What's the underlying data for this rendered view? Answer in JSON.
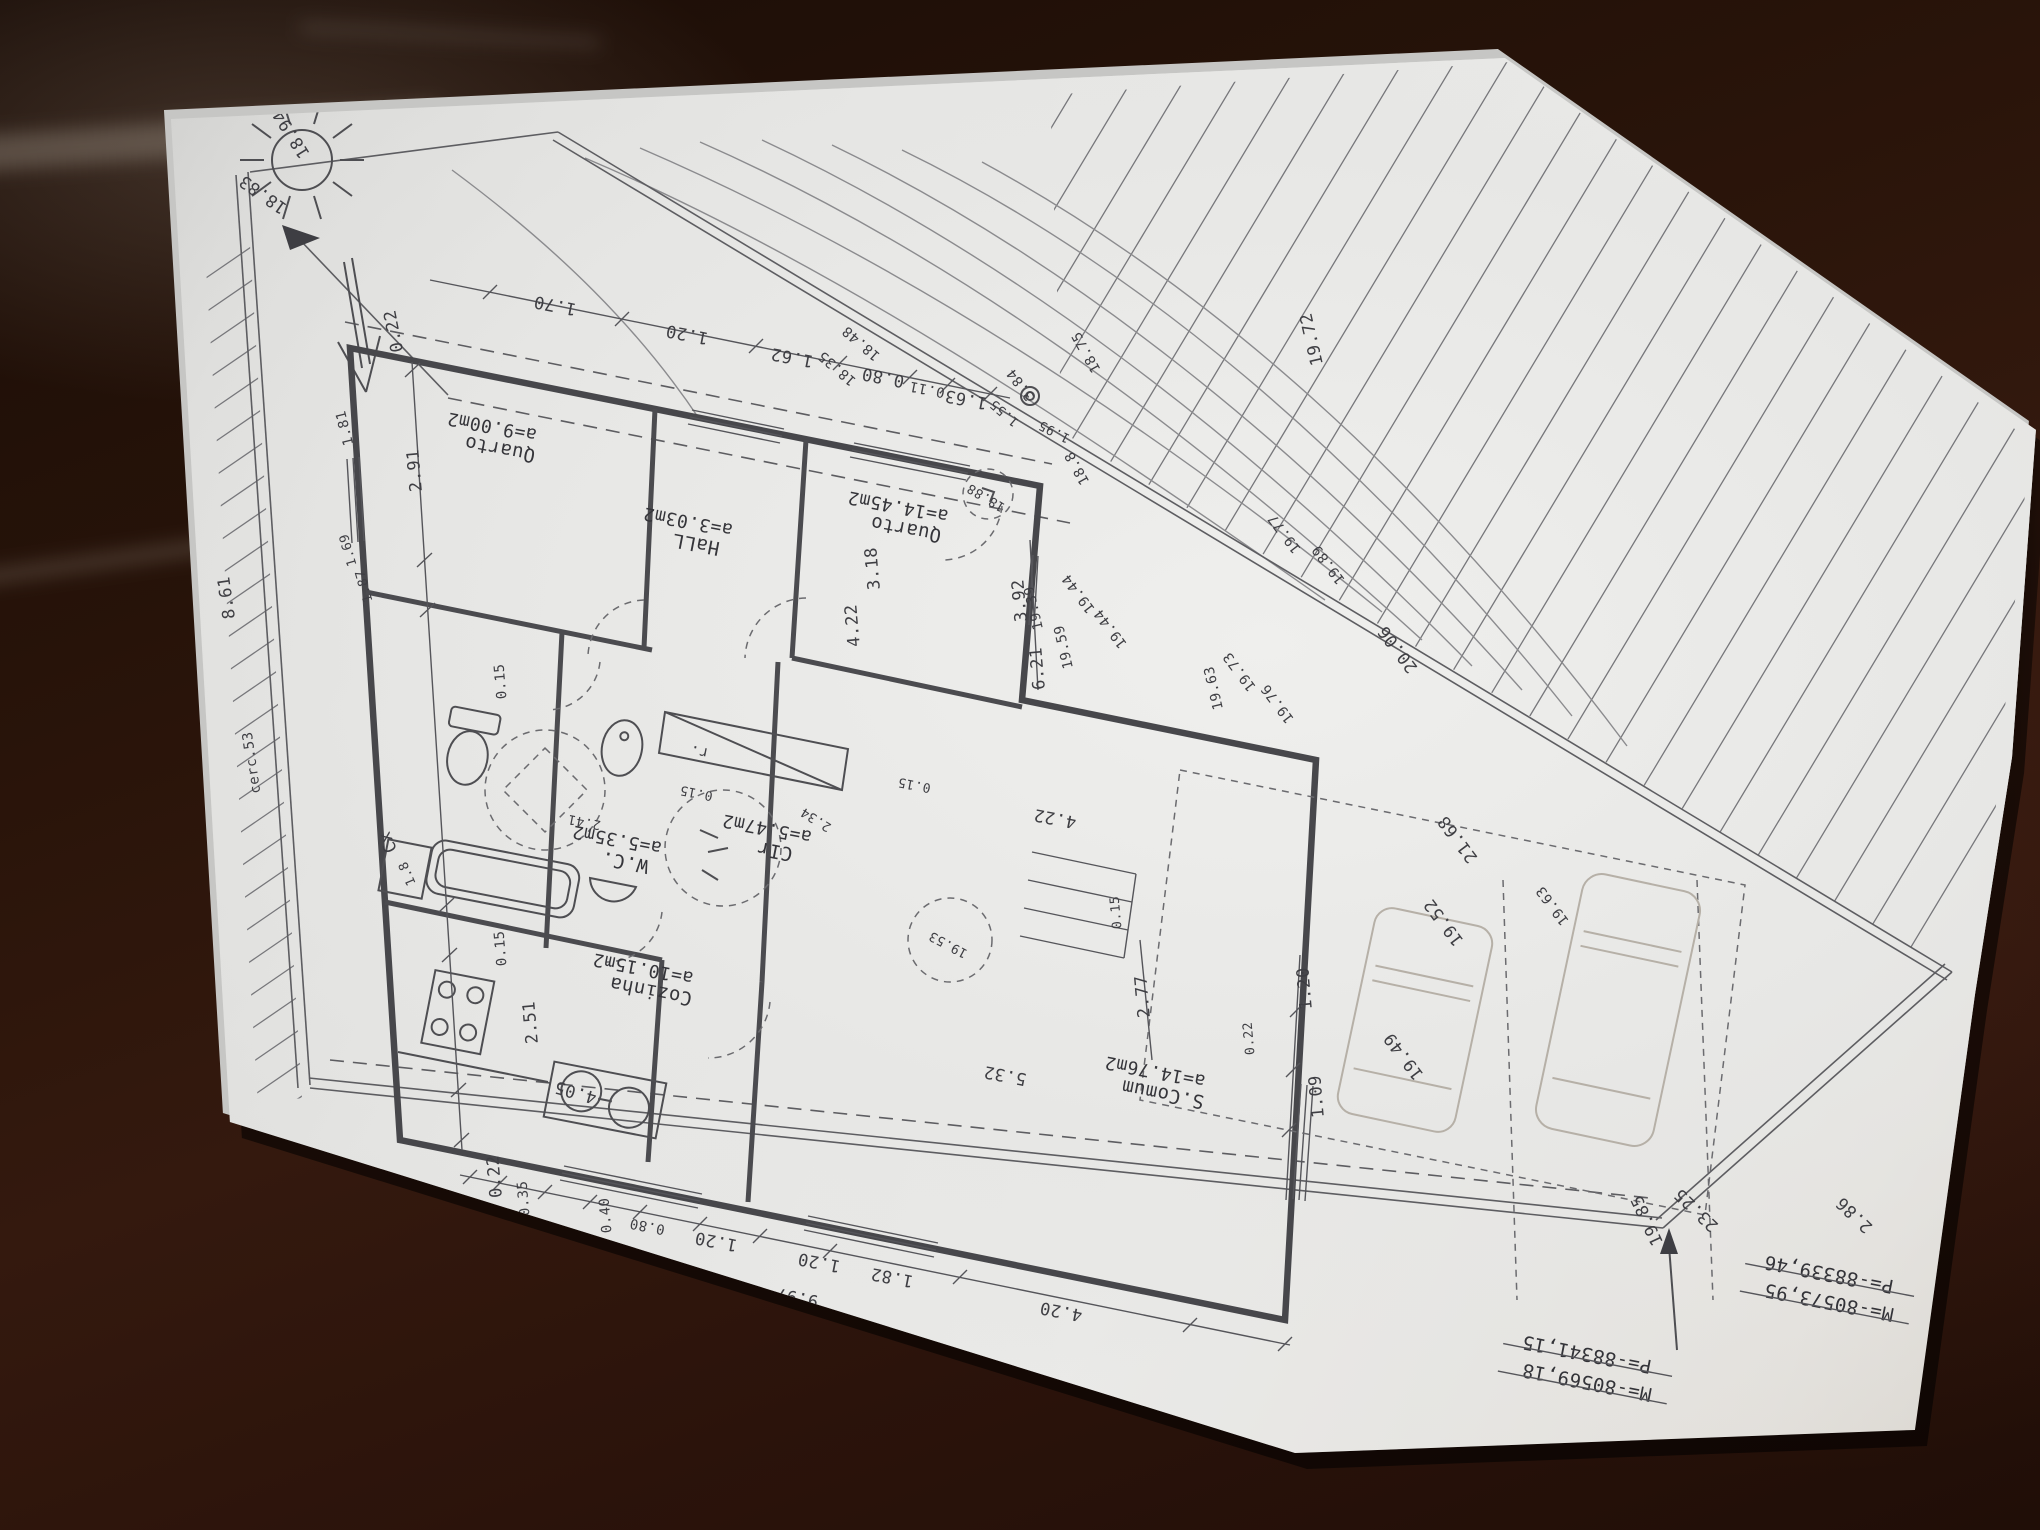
{
  "scene": {
    "type": "floor-plan-photo",
    "paper_color": "#e9e9e7",
    "ink_color": "#3e3e43",
    "wood_color": "#2b150c",
    "faint_ink": "#b6b0a7"
  },
  "plan": {
    "rooms": [
      {
        "name": "Quarto",
        "area": "a=9.00m2",
        "x": 497,
        "y": 432,
        "r": 191
      },
      {
        "name": "HaLL",
        "area": "a=3.03m2",
        "x": 693,
        "y": 527,
        "r": 191
      },
      {
        "name": "Quarto",
        "area": "a=14.45m2",
        "x": 903,
        "y": 512,
        "r": 191
      },
      {
        "name": "W.C.",
        "area": "a=5.35m2",
        "x": 622,
        "y": 845,
        "r": 191
      },
      {
        "name": "CIr",
        "area": "a=5.47m2",
        "x": 772,
        "y": 834,
        "r": 191
      },
      {
        "name": "Cozinha",
        "area": "a=10.15m2",
        "x": 648,
        "y": 974,
        "r": 191
      },
      {
        "name": "S.Comum",
        "area": "a=14.76m2",
        "x": 1160,
        "y": 1077,
        "r": 191
      }
    ],
    "annotations": [
      {
        "t": "18.94",
        "x": 296,
        "y": 131,
        "r": 238
      },
      {
        "t": "18.83",
        "x": 266,
        "y": 190,
        "r": 215
      },
      {
        "t": "1.81",
        "x": 349,
        "y": 427,
        "r": 256,
        "s": 14
      },
      {
        "t": "0.22",
        "x": 399,
        "y": 330,
        "r": 259
      },
      {
        "t": "1.70",
        "x": 556,
        "y": 300,
        "r": 191
      },
      {
        "t": "1.20",
        "x": 688,
        "y": 329,
        "r": 191
      },
      {
        "t": "1.62",
        "x": 793,
        "y": 352,
        "r": 191
      },
      {
        "t": "0.80",
        "x": 884,
        "y": 372,
        "r": 191
      },
      {
        "t": "0.11",
        "x": 928,
        "y": 385,
        "r": 191,
        "s": 14
      },
      {
        "t": "1.63",
        "x": 967,
        "y": 394,
        "r": 191
      },
      {
        "t": "3.84",
        "x": 1024,
        "y": 382,
        "r": 233,
        "s": 14
      },
      {
        "t": "1.55",
        "x": 1007,
        "y": 410,
        "r": 221,
        "s": 13
      },
      {
        "t": "1.95",
        "x": 1056,
        "y": 428,
        "r": 207,
        "s": 13
      },
      {
        "t": "18.48",
        "x": 864,
        "y": 340,
        "r": 221,
        "s": 14
      },
      {
        "t": "18.35",
        "x": 840,
        "y": 365,
        "r": 221,
        "s": 14
      },
      {
        "t": "18.75",
        "x": 1090,
        "y": 350,
        "r": 241,
        "s": 14
      },
      {
        "t": "18.8",
        "x": 1081,
        "y": 466,
        "r": 241,
        "s": 14
      },
      {
        "t": "18.88",
        "x": 988,
        "y": 494,
        "r": 211,
        "s": 13
      },
      {
        "t": "2.91",
        "x": 420,
        "y": 470,
        "r": 265
      },
      {
        "t": "0.15",
        "x": 505,
        "y": 681,
        "r": 265,
        "s": 14
      },
      {
        "t": "1.69",
        "x": 352,
        "y": 549,
        "r": 254,
        "s": 13
      },
      {
        "t": "1.87",
        "x": 368,
        "y": 585,
        "r": 254,
        "s": 13
      },
      {
        "t": "8.61",
        "x": 232,
        "y": 597,
        "r": 262
      },
      {
        "t": "cerc.53",
        "x": 256,
        "y": 762,
        "r": 262,
        "s": 14
      },
      {
        "t": "0.15",
        "x": 505,
        "y": 948,
        "r": 265,
        "s": 14
      },
      {
        "t": "2.51",
        "x": 536,
        "y": 1022,
        "r": 265
      },
      {
        "t": "0.22",
        "x": 500,
        "y": 1176,
        "r": 265
      },
      {
        "t": "Cx",
        "x": 393,
        "y": 840,
        "r": 247
      },
      {
        "t": "1.8",
        "x": 411,
        "y": 872,
        "r": 247,
        "s": 13
      },
      {
        "t": "2.41",
        "x": 585,
        "y": 818,
        "r": 191,
        "s": 13
      },
      {
        "t": "0.15",
        "x": 697,
        "y": 789,
        "r": 191,
        "s": 13
      },
      {
        "t": "2.34",
        "x": 818,
        "y": 816,
        "r": 212,
        "s": 13
      },
      {
        "t": "r.",
        "x": 700,
        "y": 747,
        "r": 191,
        "s": 15
      },
      {
        "t": "4.05",
        "x": 577,
        "y": 1087,
        "r": 196
      },
      {
        "t": "0.35",
        "x": 528,
        "y": 1198,
        "r": 265,
        "s": 14
      },
      {
        "t": "0.40",
        "x": 610,
        "y": 1215,
        "r": 265,
        "s": 14
      },
      {
        "t": "0.80",
        "x": 648,
        "y": 1222,
        "r": 191,
        "s": 14
      },
      {
        "t": "1.20",
        "x": 717,
        "y": 1236,
        "r": 191
      },
      {
        "t": "1.20",
        "x": 820,
        "y": 1257,
        "r": 191
      },
      {
        "t": "1.82",
        "x": 893,
        "y": 1272,
        "r": 191
      },
      {
        "t": "4.20",
        "x": 1062,
        "y": 1306,
        "r": 191
      },
      {
        "t": "9.97",
        "x": 798,
        "y": 1292,
        "r": 191
      },
      {
        "t": "3.18",
        "x": 878,
        "y": 568,
        "r": 265
      },
      {
        "t": "4.22",
        "x": 858,
        "y": 625,
        "r": 265
      },
      {
        "t": "3.92",
        "x": 1025,
        "y": 600,
        "r": 265
      },
      {
        "t": "6.21",
        "x": 1043,
        "y": 668,
        "r": 265
      },
      {
        "t": "0.15",
        "x": 915,
        "y": 781,
        "r": 191,
        "s": 13
      },
      {
        "t": "4.22",
        "x": 1056,
        "y": 813,
        "r": 191
      },
      {
        "t": "0.15",
        "x": 1120,
        "y": 912,
        "r": 265,
        "s": 13
      },
      {
        "t": "2.77",
        "x": 1148,
        "y": 996,
        "r": 265
      },
      {
        "t": "5.32",
        "x": 1006,
        "y": 1070,
        "r": 191
      },
      {
        "t": "0.22",
        "x": 1253,
        "y": 1038,
        "r": 265,
        "s": 13
      },
      {
        "t": "1.20",
        "x": 1310,
        "y": 988,
        "r": 265
      },
      {
        "t": "1.09",
        "x": 1322,
        "y": 1096,
        "r": 265
      },
      {
        "t": "19.53",
        "x": 950,
        "y": 941,
        "r": 208,
        "s": 13
      },
      {
        "t": "19.72",
        "x": 1317,
        "y": 338,
        "r": 257
      },
      {
        "t": "19.77",
        "x": 1288,
        "y": 531,
        "r": 233,
        "s": 14
      },
      {
        "t": "19.89",
        "x": 1332,
        "y": 562,
        "r": 233,
        "s": 14
      },
      {
        "t": "20.06",
        "x": 1402,
        "y": 646,
        "r": 233
      },
      {
        "t": "19.44",
        "x": 1082,
        "y": 591,
        "r": 233,
        "s": 14
      },
      {
        "t": "19.44",
        "x": 1114,
        "y": 626,
        "r": 233,
        "s": 14
      },
      {
        "t": "19.39",
        "x": 1038,
        "y": 607,
        "r": 257,
        "s": 14
      },
      {
        "t": "19.59",
        "x": 1068,
        "y": 646,
        "r": 257,
        "s": 14
      },
      {
        "t": "19.73",
        "x": 1243,
        "y": 669,
        "r": 233,
        "s": 14
      },
      {
        "t": "19.76",
        "x": 1281,
        "y": 701,
        "r": 233,
        "s": 14
      },
      {
        "t": "19.63",
        "x": 1218,
        "y": 687,
        "r": 257,
        "s": 14
      },
      {
        "t": "19.52",
        "x": 1448,
        "y": 919,
        "r": 233
      },
      {
        "t": "19.49",
        "x": 1408,
        "y": 1053,
        "r": 233
      },
      {
        "t": "19.63",
        "x": 1556,
        "y": 903,
        "r": 233,
        "s": 14
      },
      {
        "t": "21.68",
        "x": 1462,
        "y": 836,
        "r": 233
      },
      {
        "t": "23.25",
        "x": 1700,
        "y": 1206,
        "r": 224
      },
      {
        "t": "19.85",
        "x": 1652,
        "y": 1218,
        "r": 245
      },
      {
        "t": "2.86",
        "x": 1858,
        "y": 1211,
        "r": 224
      }
    ],
    "coordinates": [
      {
        "m": "M=-80573,95",
        "p": "P=-88339,46",
        "x": 1830,
        "y": 1278
      },
      {
        "m": "M=-80569,18",
        "p": "P=-88341,15",
        "x": 1588,
        "y": 1358
      }
    ]
  }
}
